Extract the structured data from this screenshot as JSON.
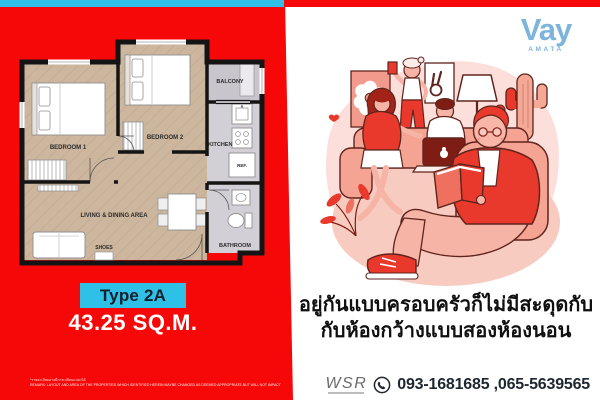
{
  "brand": {
    "name": "Vay",
    "subname": "AMATA",
    "color": "#7db4dc"
  },
  "colors": {
    "panel_red": "#f70808",
    "accent_cyan": "#2fc0e8",
    "illustration_red": "#e8392c",
    "illustration_salmon": "#f5a493",
    "illustration_pink": "#fcdeda"
  },
  "floor_plan": {
    "type_label": "Type 2A",
    "area_label": "43.25 SQ.M.",
    "rooms": {
      "bedroom1": "BEDROOM 1",
      "bedroom2": "BEDROOM 2",
      "living": "LIVING & DINING AREA",
      "kitchen": "KITCHEN",
      "balcony": "BALCONY",
      "bathroom": "BATHROOM",
      "fridge": "REF.",
      "shoes": "SHOES"
    },
    "disclaimer_th": "*รายละเอียดอาจมีการเปลี่ยนแปลงได้",
    "disclaimer_en": "REMARK: LAYOUT AND AREA OF THE PROPERTIES WHICH IDENTIFIED HEREIN MAYBE CHANGED AS DEEMED APPROPRIATE,BUT WILL NOT IMPACT UPON THE USE."
  },
  "right_panel": {
    "headline_line1": "อยู่กันแบบครอบครัวก็ไม่มีสะดุดกับ",
    "headline_line2": "กับห้องกว้างแบบสองห้องนอน",
    "contact": {
      "agency": "WSR",
      "phones": "093-1681685 ,065-5639565"
    }
  }
}
